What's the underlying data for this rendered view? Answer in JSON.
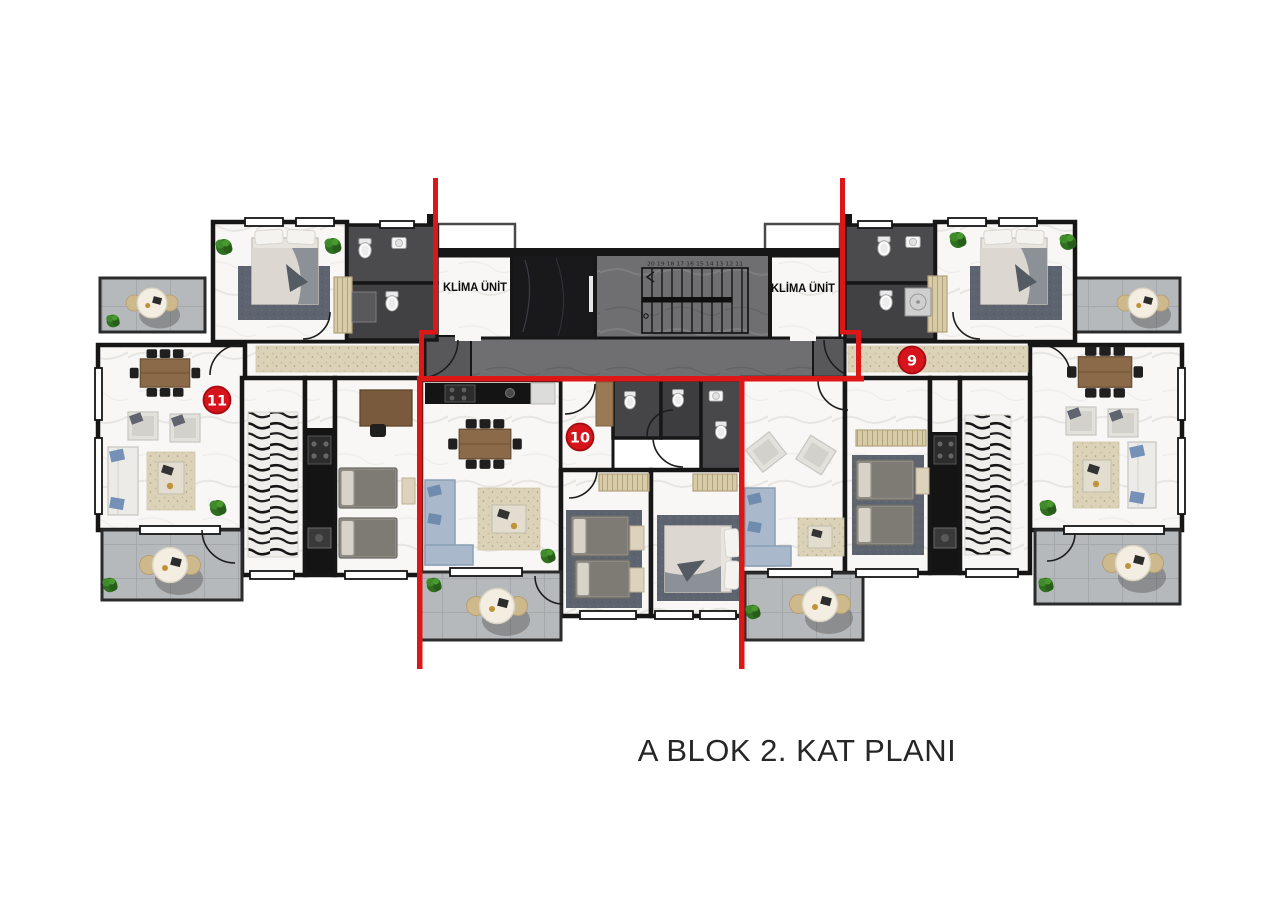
{
  "title": "A BLOK 2. KAT PLANI",
  "core": {
    "klima_left_label": "KLİMA ÜNİT",
    "klima_right_label": "KLİMA ÜNİT",
    "stair_numbers_top": "20 19 18 17 16 15 14 13 12 11",
    "stair_numbers_bottom": "1 2 3 4 5 6 7 8 9 10"
  },
  "unit_badges": [
    {
      "number": "9"
    },
    {
      "number": "10"
    },
    {
      "number": "11"
    }
  ],
  "colors": {
    "accent_red": "#dd1717",
    "badge_red": "#d7141b",
    "wall_black": "#161616",
    "corridor_gray": "#6f6f71",
    "balcony_tile_gray": "#b6b9bb",
    "marble_white": "#f8f7f5",
    "bathroom_dark": "#474749",
    "runner_beige": "#dbd2b8",
    "wood_brown": "#8a6a48",
    "sofa_blue": "#a9b8cb"
  }
}
